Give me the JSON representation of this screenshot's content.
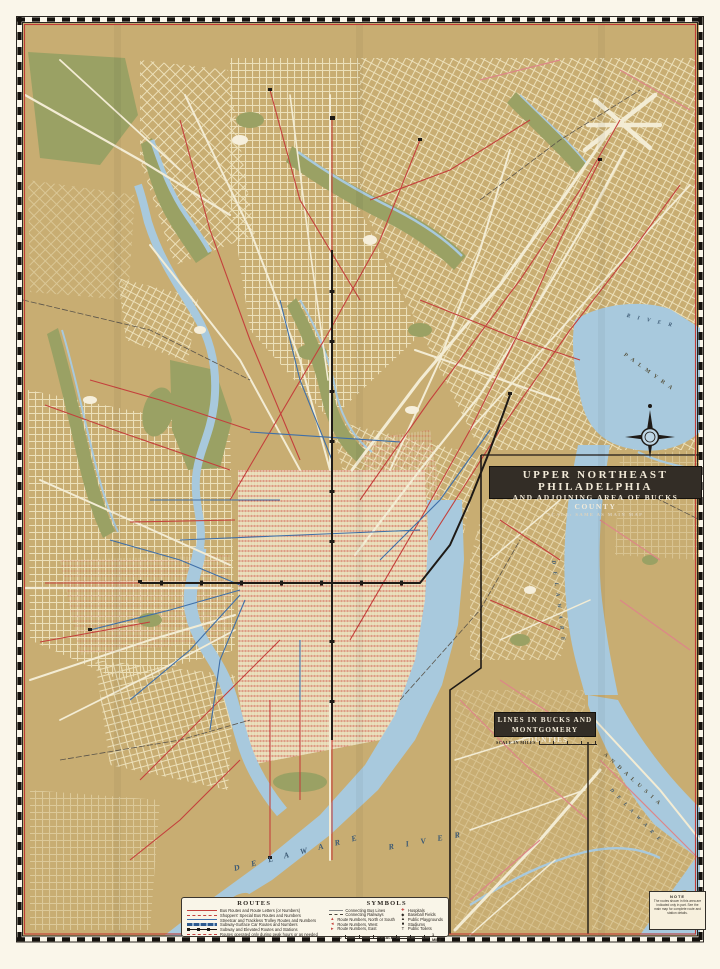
{
  "sheet": {
    "kind": "vintage transit street map, Philadelphia Transportation Co. style",
    "colors": {
      "paper_margin": "#faf6ea",
      "land": "#c8ad72",
      "street_cream": "#efe3bd",
      "water": "#a8c9dd",
      "park": "#9aa164",
      "route_red": "#c4403c",
      "route_pink": "#dd8688",
      "route_blue": "#3f6fa8",
      "subway_black": "#1e1a16",
      "border_red": "#c03a36",
      "title_box_bg": "#332d26"
    }
  },
  "inset_main_title": {
    "line1": "UPPER NORTHEAST PHILADELPHIA",
    "line2": "AND ADJOINING AREA OF BUCKS COUNTY",
    "line3": "SCALE: SAME AS MAIN MAP"
  },
  "inset_bucks_title": {
    "line1": "LINES IN BUCKS AND",
    "line2": "MONTGOMERY COUNTIES",
    "scale_label": "SCALE IN MILES"
  },
  "legend": {
    "routes_title": "ROUTES",
    "routes": [
      {
        "label": "Bus Routes and Route Letters (or Numbers)",
        "style": "red-solid"
      },
      {
        "label": "Shoppers' Special Bus Routes and Numbers",
        "style": "red-dashed"
      },
      {
        "label": "Streetcar and Trackless Trolley Routes and Numbers",
        "style": "blue-solid"
      },
      {
        "label": "Subway-Surface Car Routes and Numbers",
        "style": "blue-banded"
      },
      {
        "label": "Subway and Elevated Routes and Stations",
        "style": "black-stations"
      },
      {
        "label": "Routes operated only during peak hours or as needed",
        "style": "red-short-dash"
      }
    ],
    "symbols_title": "SYMBOLS",
    "symbols_left": [
      {
        "label": "Connecting Bus Lines",
        "style": "thin-gray"
      },
      {
        "label": "Connecting Railways",
        "style": "dashed-dark"
      },
      {
        "label": "Route Numbers, North or South",
        "glyph": "▲"
      },
      {
        "label": "Route Numbers, West",
        "glyph": "◄"
      },
      {
        "label": "Route Numbers, East",
        "glyph": "►"
      }
    ],
    "symbols_right": [
      {
        "label": "Hospitals",
        "glyph": "✚"
      },
      {
        "label": "Baseball Fields",
        "glyph": "◆"
      },
      {
        "label": "Public Playgrounds",
        "glyph": "▲"
      },
      {
        "label": "Stadiums",
        "glyph": "■"
      },
      {
        "label": "Public Toilets",
        "glyph": "T"
      }
    ],
    "scale": {
      "zero": "0",
      "label": "SCALE",
      "mile": "1 MILE"
    }
  },
  "note": {
    "title": "NOTE",
    "body": "The routes shown in this area are indicated only in part. See the main map for complete route and station details."
  },
  "map_labels": {
    "delaware_main": "D E L A W A R E",
    "river_main": "R I V E R",
    "river_inset_top": "R I V E R",
    "delaware_inset": "D E L A W A R E",
    "delaware_andalusia": "D E L A W A R E",
    "palmyra": "P A L M Y R A",
    "andalusia": "A N D A L U S I A"
  }
}
